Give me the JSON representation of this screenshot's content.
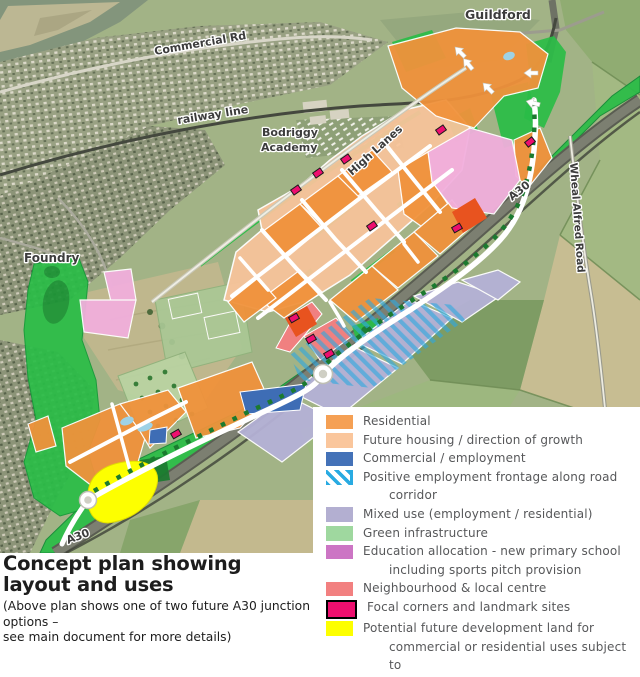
{
  "map": {
    "labels": [
      {
        "text": "Guildford"
      },
      {
        "text": "Commercial Rd"
      },
      {
        "text": "railway line"
      },
      {
        "lines": [
          "Bodriggy",
          "Academy"
        ]
      },
      {
        "text": "High Lanes"
      },
      {
        "text": "A30"
      },
      {
        "text": "Wheal Alfred Road"
      },
      {
        "text": "Foundry"
      },
      {
        "text": "A30"
      }
    ]
  },
  "legend": {
    "items": [
      {
        "id": "residential",
        "label": "Residential",
        "lines": [
          "Residential"
        ],
        "color": "#F5A054",
        "type": "solid"
      },
      {
        "id": "future-housing",
        "label": "Future housing / direction of growth",
        "lines": [
          "Future housing / direction of growth"
        ],
        "color": "#FAC69C",
        "type": "solid"
      },
      {
        "id": "commercial",
        "label": "Commercial  / employment",
        "lines": [
          "Commercial  / employment"
        ],
        "color": "#4472B8",
        "type": "solid"
      },
      {
        "id": "employment-frontage",
        "label": "Positive employment frontage along road corridor",
        "lines": [
          "Positive employment frontage along road",
          "corridor"
        ],
        "color": "#29ABE2",
        "type": "hatch"
      },
      {
        "id": "mixed-use",
        "label": "Mixed use (employment / residential)",
        "lines": [
          "Mixed use (employment / residential)"
        ],
        "color": "#B3AFD1",
        "type": "solid"
      },
      {
        "id": "green-infrastructure",
        "label": "Green infrastructure",
        "lines": [
          "Green infrastructure"
        ],
        "color": "#9FD89F",
        "type": "solid"
      },
      {
        "id": "education",
        "label": "Education allocation - new primary school including sports pitch provision",
        "lines": [
          "Education allocation - new primary school",
          "including sports pitch provision"
        ],
        "color": "#CC75C4",
        "type": "solid"
      },
      {
        "id": "neighbourhood-centre",
        "label": "Neighbourhood & local centre",
        "lines": [
          "Neighbourhood & local centre"
        ],
        "color": "#F28080",
        "type": "solid"
      },
      {
        "id": "focal-corners",
        "label": "Focal corners and landmark sites",
        "lines": [
          "Focal corners and landmark sites"
        ],
        "color": "#EE0F6F",
        "type": "solid",
        "border": "#000000"
      },
      {
        "id": "potential-development",
        "label": "Potential future development land  for commercial or residential uses subject to noise assessments",
        "lines": [
          "Potential future development land  for",
          "commercial or residential uses subject to",
          "noise assessments"
        ],
        "color": "#FDFF00",
        "type": "solid"
      }
    ]
  },
  "title_block": {
    "title": "Concept plan showing layout and uses",
    "subtitle_lines": [
      "(Above plan shows one of two future A30 junction options –",
      "see main document for more details)"
    ]
  }
}
